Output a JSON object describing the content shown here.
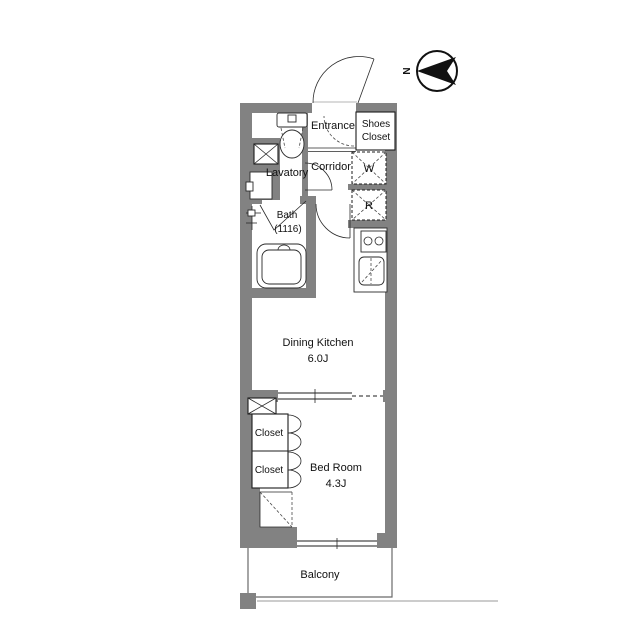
{
  "compass": {
    "label": "N"
  },
  "rooms": {
    "entrance": {
      "label": "Entrance"
    },
    "shoes_closet": {
      "line1": "Shoes",
      "line2": "Closet"
    },
    "corridor": {
      "label": "Corridor"
    },
    "lavatory": {
      "label": "Lavatory"
    },
    "bath": {
      "label": "Bath",
      "size": "(1116)"
    },
    "washer": {
      "label": "W"
    },
    "fridge": {
      "label": "R"
    },
    "dining_kitchen": {
      "label": "Dining Kitchen",
      "size": "6.0J"
    },
    "closet_top": {
      "label": "Closet"
    },
    "closet_bottom": {
      "label": "Closet"
    },
    "bedroom": {
      "label": "Bed Room",
      "size": "4.3J"
    },
    "balcony": {
      "label": "Balcony"
    }
  },
  "colors": {
    "wall": "#828282",
    "line": "#1c1c1c",
    "background": "#ffffff"
  }
}
